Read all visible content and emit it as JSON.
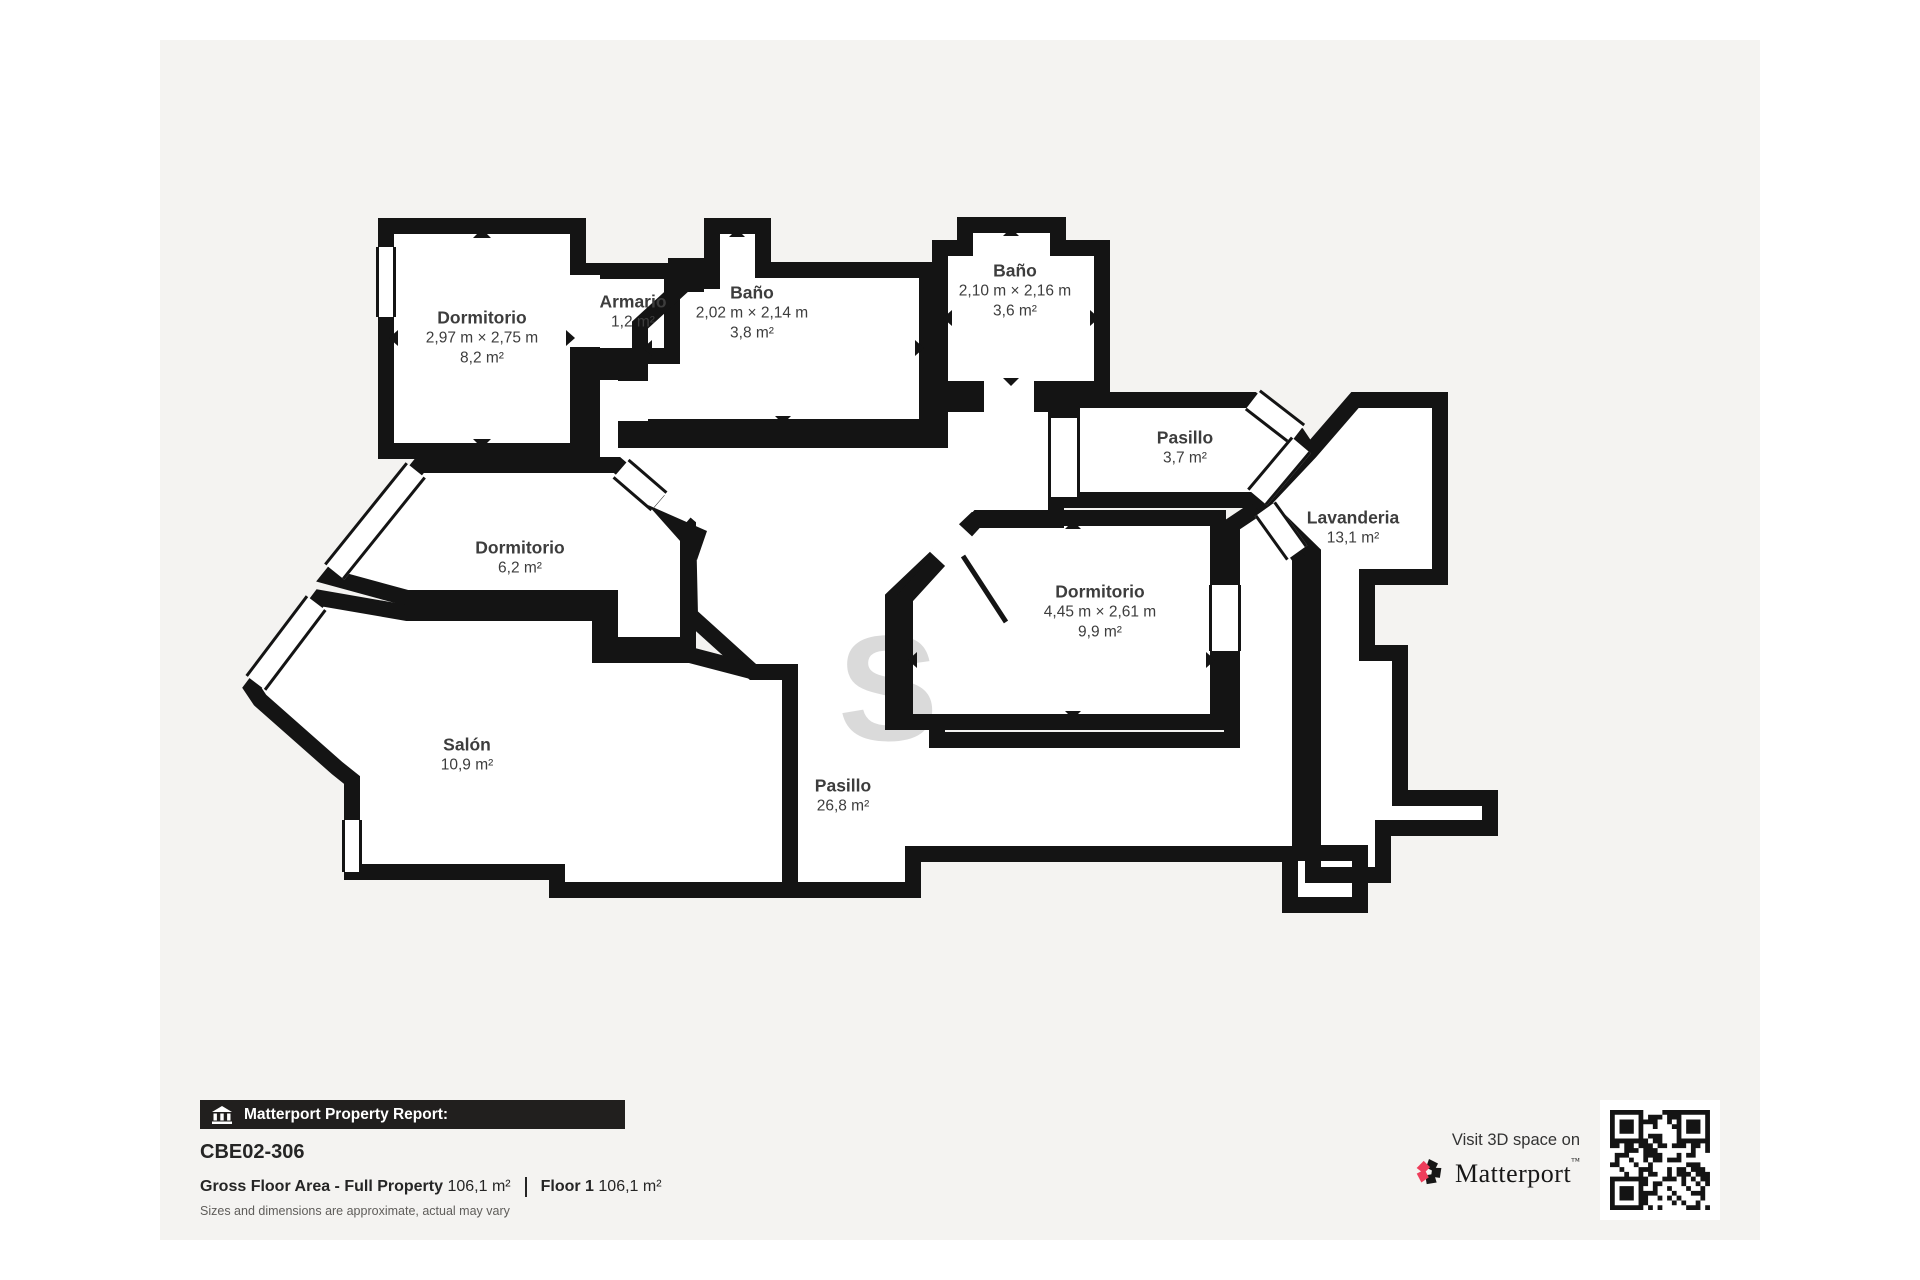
{
  "page": {
    "background": "#ffffff",
    "card_background": "#f4f3f1"
  },
  "rooms": [
    {
      "name": "Dormitorio",
      "dims": "2,97 m × 2,75 m",
      "area": "8,2 m²"
    },
    {
      "name": "Armario",
      "dims": "",
      "area": "1,2 m²"
    },
    {
      "name": "Baño",
      "dims": "2,02 m × 2,14 m",
      "area": "3,8 m²"
    },
    {
      "name": "Baño",
      "dims": "2,10 m × 2,16 m",
      "area": "3,6 m²"
    },
    {
      "name": "Pasillo",
      "dims": "",
      "area": "3,7 m²"
    },
    {
      "name": "Lavanderia",
      "dims": "",
      "area": "13,1 m²"
    },
    {
      "name": "Dormitorio",
      "dims": "4,45 m × 2,61 m",
      "area": "9,9 m²"
    },
    {
      "name": "Dormitorio",
      "dims": "",
      "area": "6,2 m²"
    },
    {
      "name": "Salón",
      "dims": "",
      "area": "10,9 m²"
    },
    {
      "name": "Pasillo",
      "dims": "",
      "area": "26,8 m²"
    }
  ],
  "watermark": "S",
  "footer": {
    "report_bar": "Matterport Property Report:",
    "property_id": "CBE02-306",
    "gfa_label": "Gross Floor Area - Full Property",
    "gfa_value": "106,1 m²",
    "floor_label": "Floor 1",
    "floor_value": "106,1 m²",
    "disclaimer": "Sizes and dimensions are approximate, actual may vary"
  },
  "cta": {
    "visit_text": "Visit 3D space on",
    "brand": "Matterport",
    "brand_mark": "™"
  },
  "colors": {
    "wall": "#141414",
    "accent_pink": "#ee3d5b",
    "bar_bg": "#211f1e",
    "label": "#3d3d3d"
  }
}
